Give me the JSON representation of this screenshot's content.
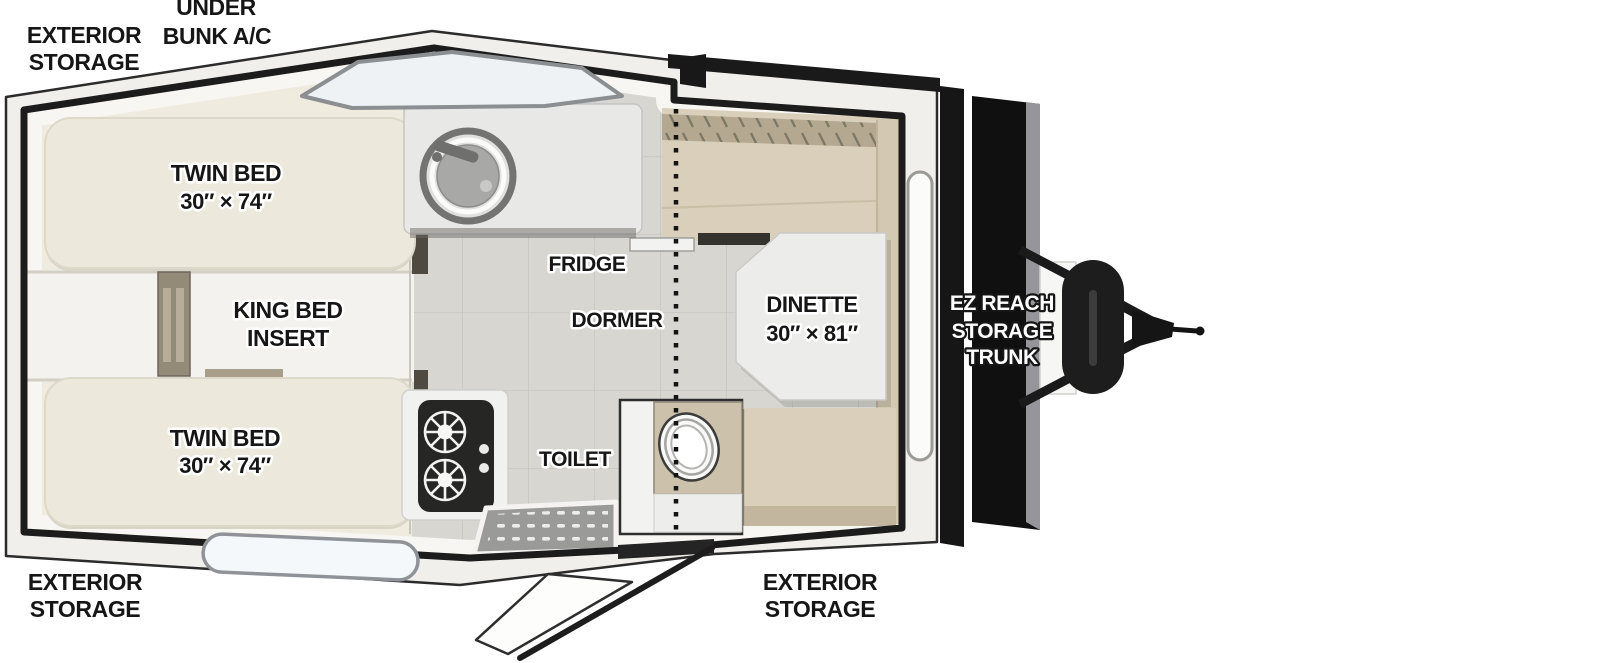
{
  "title": "A-frame pop-up camper floor plan",
  "palette": {
    "outline": "#2b2b2b",
    "wall": "#1c1c1c",
    "roof_band": "#f0efeb",
    "floor_cream": "#eeeade",
    "tile_gray": "#d7d6d1",
    "cushion_tan": "#d9cfba",
    "bed_cream": "#ece9dc",
    "trunk_black": "#141414",
    "glass": "#eef2f4"
  },
  "labels": {
    "exterior_storage_top": {
      "line1": "EXTERIOR",
      "line2": "STORAGE"
    },
    "under_bunk_ac": {
      "line1": "UNDER",
      "line2": "BUNK A/C"
    },
    "twin_bed_top": {
      "line1": "TWIN BED",
      "line2": "30″ × 74″"
    },
    "king_bed_insert": {
      "line1": "KING BED",
      "line2": "INSERT"
    },
    "twin_bed_bottom": {
      "line1": "TWIN BED",
      "line2": "30″ × 74″"
    },
    "fridge": {
      "line1": "FRIDGE"
    },
    "dormer": {
      "line1": "DORMER"
    },
    "dinette": {
      "line1": "DINETTE",
      "line2": "30″ × 81″"
    },
    "toilet": {
      "line1": "TOILET"
    },
    "ez_reach_storage_trunk": {
      "line1": "EZ REACH",
      "line2": "STORAGE",
      "line3": "TRUNK"
    },
    "exterior_storage_bottom_left": {
      "line1": "EXTERIOR",
      "line2": "STORAGE"
    },
    "exterior_storage_bottom_center": {
      "line1": "EXTERIOR",
      "line2": "STORAGE"
    }
  }
}
